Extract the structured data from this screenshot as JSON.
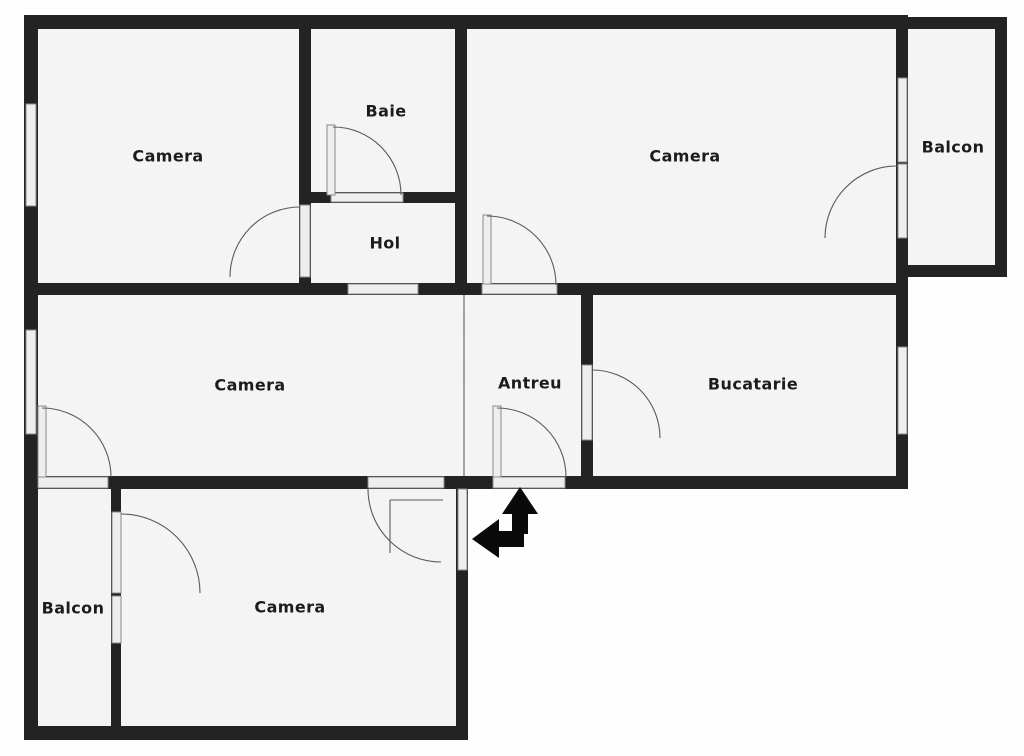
{
  "watermark": "TARCO",
  "rooms": [
    {
      "id": "camera-top-left",
      "label": "Camera"
    },
    {
      "id": "baie",
      "label": "Baie"
    },
    {
      "id": "hol",
      "label": "Hol"
    },
    {
      "id": "camera-top-right",
      "label": "Camera"
    },
    {
      "id": "balcon-top-right",
      "label": "Balcon"
    },
    {
      "id": "camera-middle",
      "label": "Camera"
    },
    {
      "id": "antreu",
      "label": "Antreu"
    },
    {
      "id": "bucatarie",
      "label": "Bucatarie"
    },
    {
      "id": "balcon-bottom-left",
      "label": "Balcon"
    },
    {
      "id": "camera-bottom",
      "label": "Camera"
    }
  ],
  "colors": {
    "wall": "#232323",
    "room_fill": "#f4f4f5",
    "opening_fill": "#eeeeee",
    "arrow": "#0a0a0a",
    "label": "#1c1c1c"
  }
}
